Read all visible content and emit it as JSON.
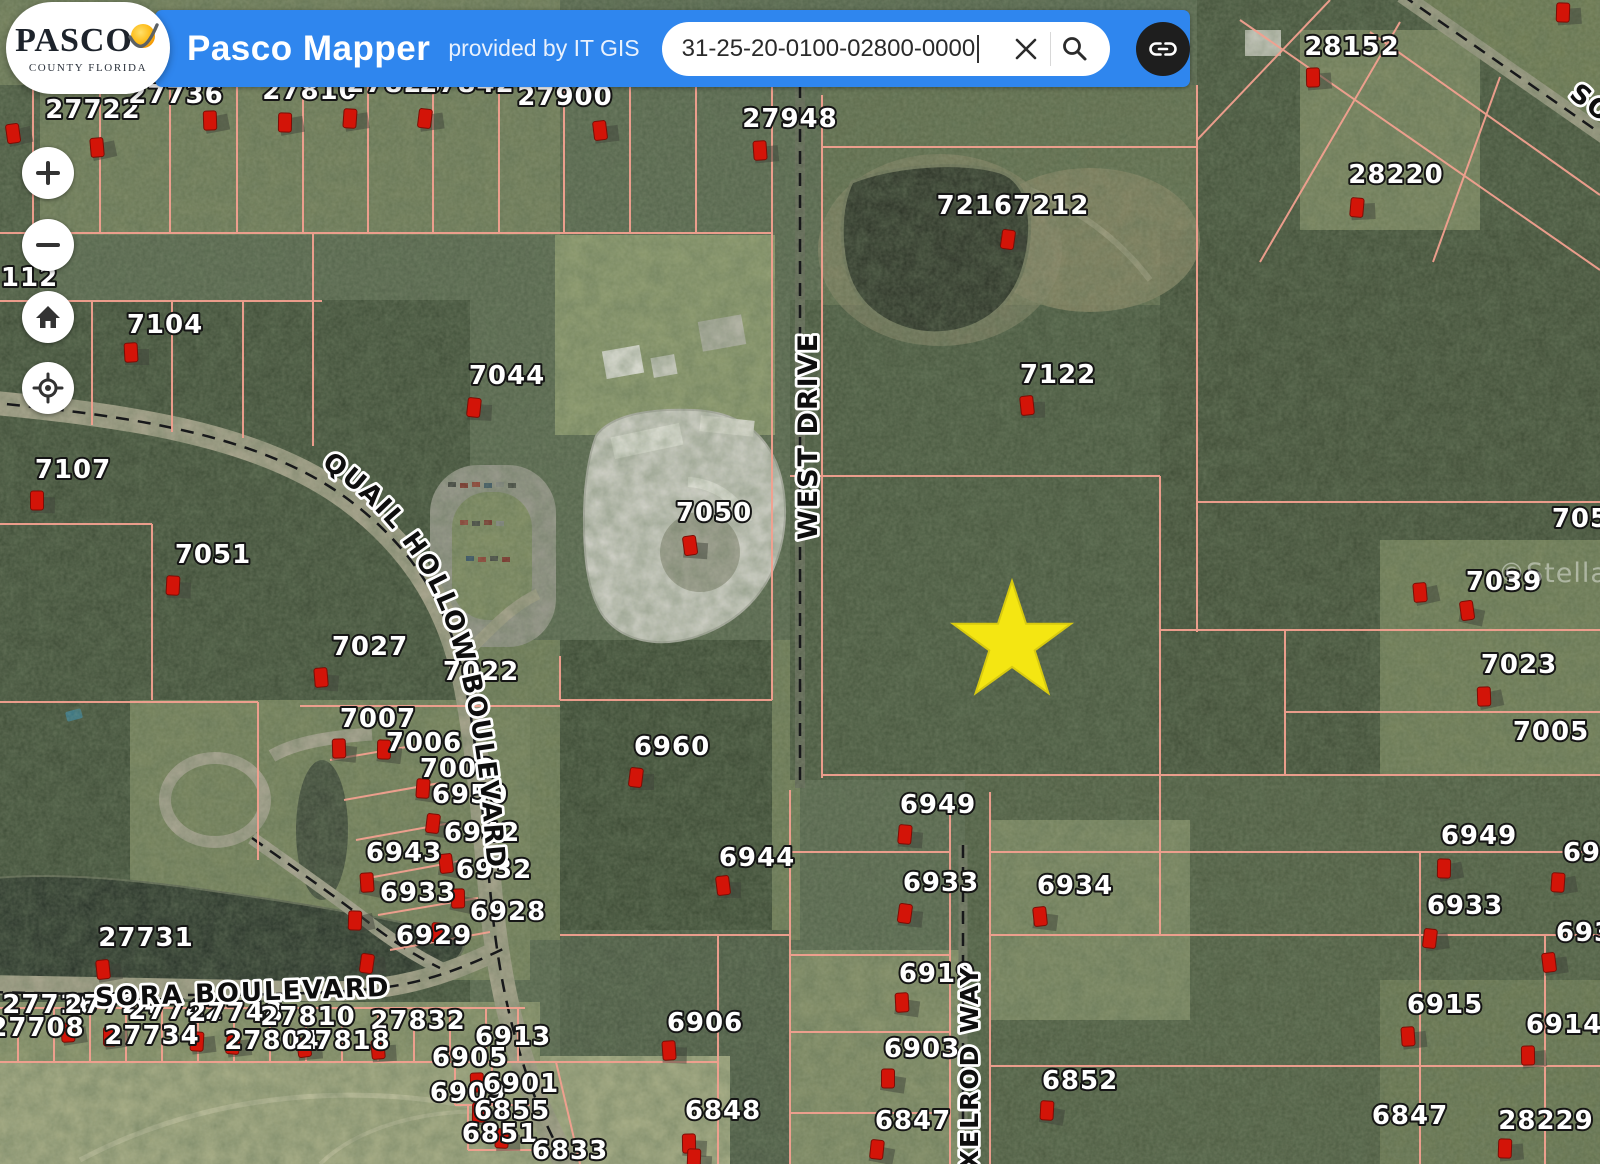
{
  "header": {
    "logo": {
      "line1": "PASCO",
      "line2": "COUNTY FLORIDA"
    },
    "title": "Pasco Mapper",
    "subtitle": "provided by IT GIS",
    "search": {
      "value": "31-25-20-0100-02800-0000"
    }
  },
  "icons": {
    "clear": "x-icon",
    "search": "magnifier-icon",
    "share": "link-icon",
    "zoom_in": "plus-icon",
    "zoom_out": "minus-icon",
    "home": "home-icon",
    "locate": "crosshair-icon",
    "marker": "house-marker-icon",
    "star": "star-icon"
  },
  "colors": {
    "header_blue": "#2f86ee",
    "marker_red": "#d31408",
    "star_yellow": "#f4e612",
    "parcel_line": "#f2a08f",
    "road_dash": "#17181a"
  },
  "map": {
    "watermark": "©Stellar MLS",
    "star": {
      "x": 1012,
      "y": 643,
      "r": 62
    },
    "road_labels": [
      {
        "text": "QUAIL HOLLOW BOULEVARD",
        "path": "qhb",
        "offset": 6
      },
      {
        "text": "WEST DRIVE",
        "x": 817,
        "y": 436,
        "rotate": -90,
        "size": 27
      },
      {
        "text": "SORA BOULEVARD",
        "x": 243,
        "y": 1001,
        "rotate": -2,
        "size": 26
      },
      {
        "text": "AXELROD WAY",
        "x": 978,
        "y": 1078,
        "rotate": -90,
        "size": 25
      },
      {
        "text": "SO",
        "x": 1586,
        "y": 110,
        "rotate": 37,
        "size": 26
      }
    ],
    "parcel_labels": [
      {
        "t": "27722",
        "x": 93,
        "y": 118
      },
      {
        "t": "27736",
        "x": 176,
        "y": 103
      },
      {
        "t": "27810",
        "x": 310,
        "y": 99
      },
      {
        "t": "27828",
        "x": 394,
        "y": 92
      },
      {
        "t": "27842",
        "x": 467,
        "y": 92
      },
      {
        "t": "27900",
        "x": 565,
        "y": 105
      },
      {
        "t": "27948",
        "x": 790,
        "y": 127
      },
      {
        "t": "28152",
        "x": 1352,
        "y": 55
      },
      {
        "t": "28220",
        "x": 1396,
        "y": 183
      },
      {
        "t": "72167212",
        "x": 1013,
        "y": 214
      },
      {
        "t": "7122",
        "x": 1058,
        "y": 383
      },
      {
        "t": "7112",
        "x": 20,
        "y": 286
      },
      {
        "t": "7104",
        "x": 165,
        "y": 333
      },
      {
        "t": "7107",
        "x": 73,
        "y": 478
      },
      {
        "t": "7051",
        "x": 213,
        "y": 563
      },
      {
        "t": "7044",
        "x": 507,
        "y": 384
      },
      {
        "t": "7050",
        "x": 714,
        "y": 521
      },
      {
        "t": "7027",
        "x": 370,
        "y": 655
      },
      {
        "t": "7022",
        "x": 481,
        "y": 680
      },
      {
        "t": "7007",
        "x": 378,
        "y": 727
      },
      {
        "t": "7006",
        "x": 424,
        "y": 751
      },
      {
        "t": "7002",
        "x": 458,
        "y": 777
      },
      {
        "t": "6950",
        "x": 470,
        "y": 803
      },
      {
        "t": "6942",
        "x": 482,
        "y": 841
      },
      {
        "t": "6943",
        "x": 404,
        "y": 861
      },
      {
        "t": "6932",
        "x": 494,
        "y": 878
      },
      {
        "t": "6933",
        "x": 418,
        "y": 901
      },
      {
        "t": "6928",
        "x": 508,
        "y": 920
      },
      {
        "t": "6929",
        "x": 434,
        "y": 944
      },
      {
        "t": "27731",
        "x": 146,
        "y": 946
      },
      {
        "t": "6960",
        "x": 672,
        "y": 755
      },
      {
        "t": "6944",
        "x": 757,
        "y": 866
      },
      {
        "t": "27716",
        "x": 50,
        "y": 1013
      },
      {
        "t": "27724",
        "x": 112,
        "y": 1013
      },
      {
        "t": "27742",
        "x": 176,
        "y": 1019
      },
      {
        "t": "27748",
        "x": 236,
        "y": 1021
      },
      {
        "t": "27810",
        "x": 308,
        "y": 1025
      },
      {
        "t": "27832",
        "x": 418,
        "y": 1029
      },
      {
        "t": "27708",
        "x": 37,
        "y": 1036
      },
      {
        "t": "27734",
        "x": 152,
        "y": 1044
      },
      {
        "t": "27804",
        "x": 272,
        "y": 1049
      },
      {
        "t": "27818",
        "x": 343,
        "y": 1049
      },
      {
        "t": "6913",
        "x": 513,
        "y": 1045
      },
      {
        "t": "6905",
        "x": 470,
        "y": 1066
      },
      {
        "t": "6909",
        "x": 468,
        "y": 1101
      },
      {
        "t": "6901",
        "x": 521,
        "y": 1092
      },
      {
        "t": "6855",
        "x": 512,
        "y": 1119
      },
      {
        "t": "6851",
        "x": 500,
        "y": 1142
      },
      {
        "t": "6833",
        "x": 570,
        "y": 1159
      },
      {
        "t": "6906",
        "x": 705,
        "y": 1031
      },
      {
        "t": "6848",
        "x": 723,
        "y": 1119
      },
      {
        "t": "6919",
        "x": 937,
        "y": 982
      },
      {
        "t": "6903",
        "x": 922,
        "y": 1057
      },
      {
        "t": "6852",
        "x": 1080,
        "y": 1089
      },
      {
        "t": "6847",
        "x": 913,
        "y": 1129
      },
      {
        "t": "6949",
        "x": 938,
        "y": 813
      },
      {
        "t": "6933",
        "x": 941,
        "y": 891
      },
      {
        "t": "6934",
        "x": 1075,
        "y": 894
      },
      {
        "t": "7053",
        "x": 1590,
        "y": 527
      },
      {
        "t": "7039",
        "x": 1504,
        "y": 590
      },
      {
        "t": "7023",
        "x": 1519,
        "y": 673
      },
      {
        "t": "7005",
        "x": 1551,
        "y": 740
      },
      {
        "t": "6949",
        "x": 1479,
        "y": 844
      },
      {
        "t": "6949",
        "x": 1601,
        "y": 861
      },
      {
        "t": "6933",
        "x": 1465,
        "y": 914
      },
      {
        "t": "6933",
        "x": 1594,
        "y": 941
      },
      {
        "t": "6915",
        "x": 1445,
        "y": 1013
      },
      {
        "t": "6914",
        "x": 1564,
        "y": 1033
      },
      {
        "t": "6847",
        "x": 1410,
        "y": 1124
      },
      {
        "t": "28229",
        "x": 1546,
        "y": 1129
      }
    ],
    "markers": [
      [
        13,
        133
      ],
      [
        97,
        147
      ],
      [
        210,
        120
      ],
      [
        285,
        122
      ],
      [
        350,
        118
      ],
      [
        425,
        118
      ],
      [
        600,
        130
      ],
      [
        760,
        150
      ],
      [
        1313,
        77
      ],
      [
        1563,
        12
      ],
      [
        1357,
        207
      ],
      [
        1008,
        239
      ],
      [
        1027,
        405
      ],
      [
        131,
        352
      ],
      [
        37,
        500
      ],
      [
        173,
        585
      ],
      [
        474,
        407
      ],
      [
        690,
        545
      ],
      [
        321,
        677
      ],
      [
        339,
        748
      ],
      [
        384,
        749
      ],
      [
        423,
        788
      ],
      [
        433,
        823
      ],
      [
        446,
        863
      ],
      [
        367,
        882
      ],
      [
        458,
        898
      ],
      [
        355,
        920
      ],
      [
        438,
        932
      ],
      [
        367,
        963
      ],
      [
        103,
        969
      ],
      [
        68,
        1032
      ],
      [
        110,
        1036
      ],
      [
        197,
        1041
      ],
      [
        233,
        1044
      ],
      [
        304,
        1047
      ],
      [
        378,
        1049
      ],
      [
        477,
        1082
      ],
      [
        479,
        1112
      ],
      [
        502,
        1138
      ],
      [
        636,
        777
      ],
      [
        723,
        885
      ],
      [
        669,
        1050
      ],
      [
        689,
        1143
      ],
      [
        694,
        1158
      ],
      [
        905,
        834
      ],
      [
        905,
        913
      ],
      [
        1040,
        916
      ],
      [
        902,
        1002
      ],
      [
        888,
        1078
      ],
      [
        1047,
        1110
      ],
      [
        877,
        1149
      ],
      [
        1467,
        610
      ],
      [
        1420,
        592
      ],
      [
        1484,
        696
      ],
      [
        1444,
        868
      ],
      [
        1558,
        882
      ],
      [
        1430,
        938
      ],
      [
        1549,
        962
      ],
      [
        1408,
        1036
      ],
      [
        1528,
        1055
      ],
      [
        1505,
        1148
      ]
    ]
  }
}
